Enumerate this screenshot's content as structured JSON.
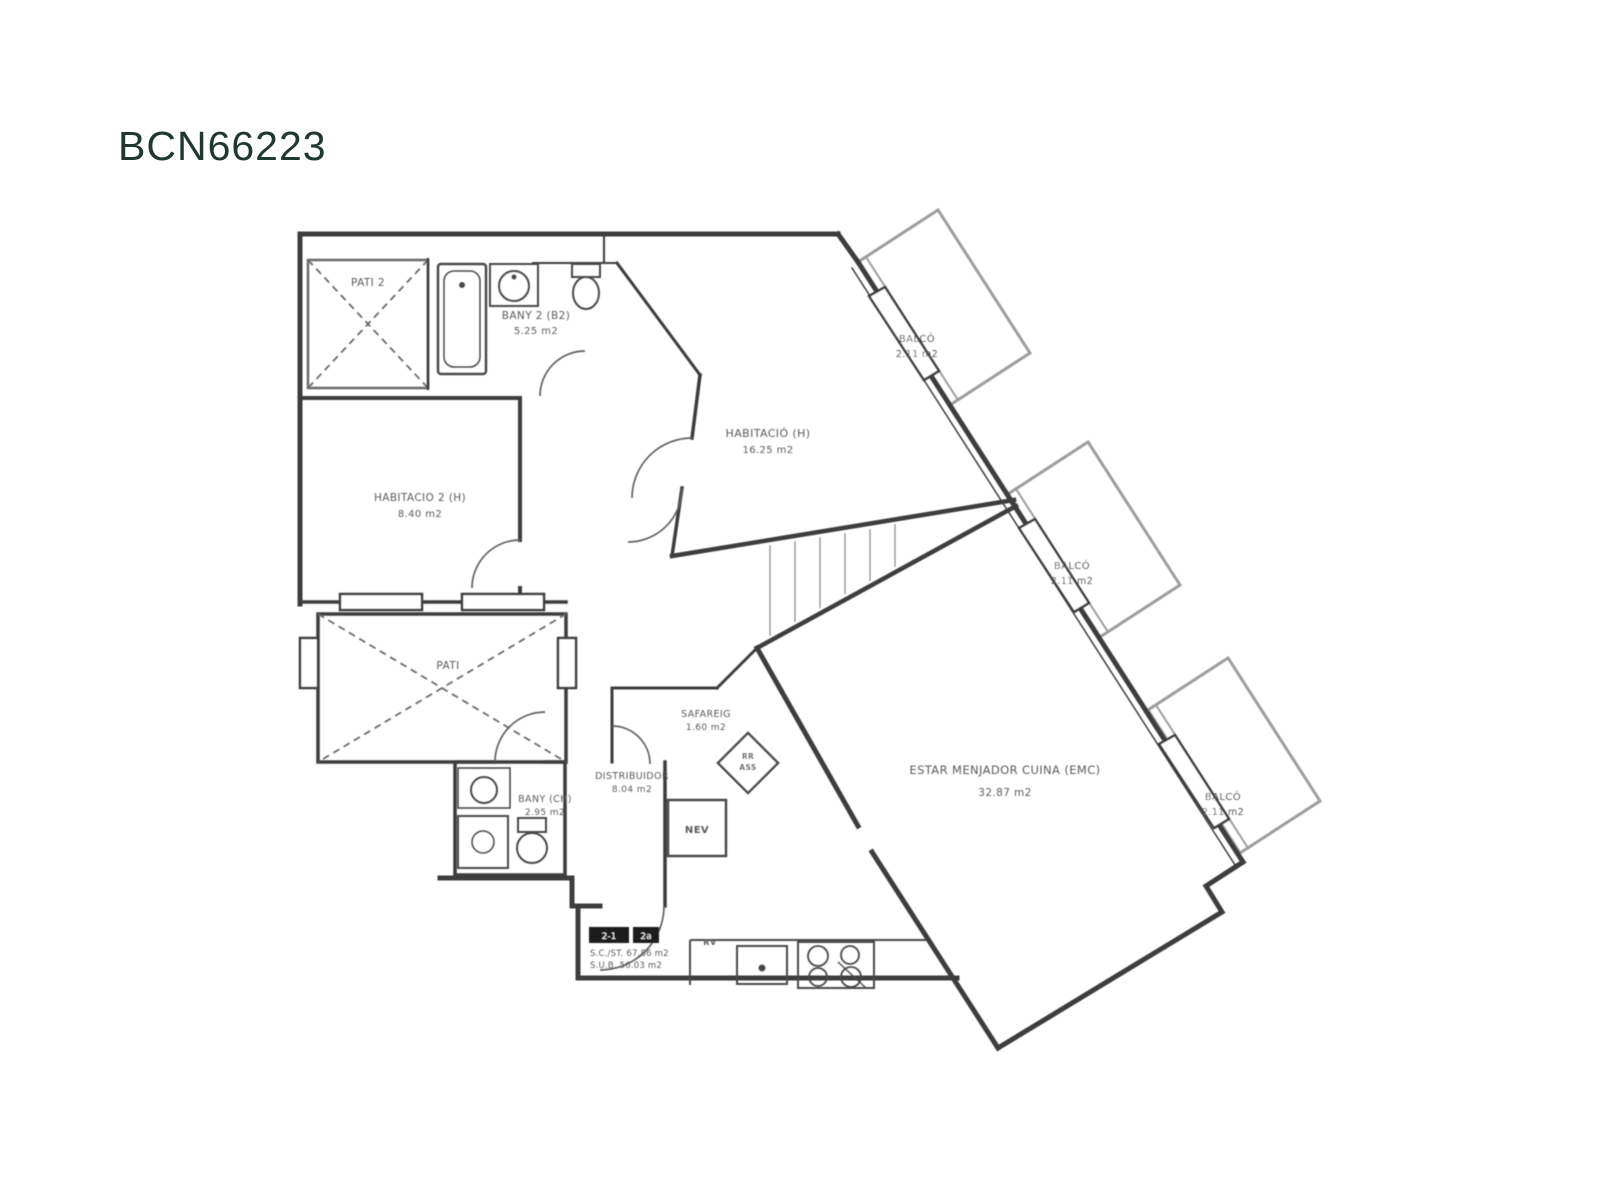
{
  "page": {
    "title": "BCN66223",
    "title_color": "#203832",
    "background": "#ffffff"
  },
  "plan": {
    "pati2": {
      "name": "PATI 2"
    },
    "bany2": {
      "name": "BANY 2 (B2)",
      "area": "5.25 m2"
    },
    "habitacio_h": {
      "name": "HABITACIÓ (H)",
      "area": "16.25 m2"
    },
    "balco": {
      "name": "BALCÓ",
      "area": "2.11 m2"
    },
    "habitacio2": {
      "name": "HABITACIO 2 (H)",
      "area": "8.40 m2"
    },
    "pati": {
      "name": "PATI"
    },
    "safareig": {
      "name": "SAFAREIG",
      "area": "1.60 m2"
    },
    "distribuidor": {
      "name": "DISTRIBUIDOR",
      "area": "8.04 m2"
    },
    "bany_ch": {
      "name": "BANY (CH)",
      "area": "2.95 m2"
    },
    "emc": {
      "name": "ESTAR MENJADOR CUINA (EMC)",
      "area": "32.87 m2"
    },
    "fridge_label": "NEV",
    "vent_label": "RV",
    "elevator": {
      "line1": "RR",
      "line2": "ASS"
    },
    "entry": {
      "unit_left": "2-1",
      "unit_right": "2a",
      "surface_line1": "S.C./ST. 67.86 m2",
      "surface_line2": "S.U.B. 56.03 m2"
    }
  }
}
